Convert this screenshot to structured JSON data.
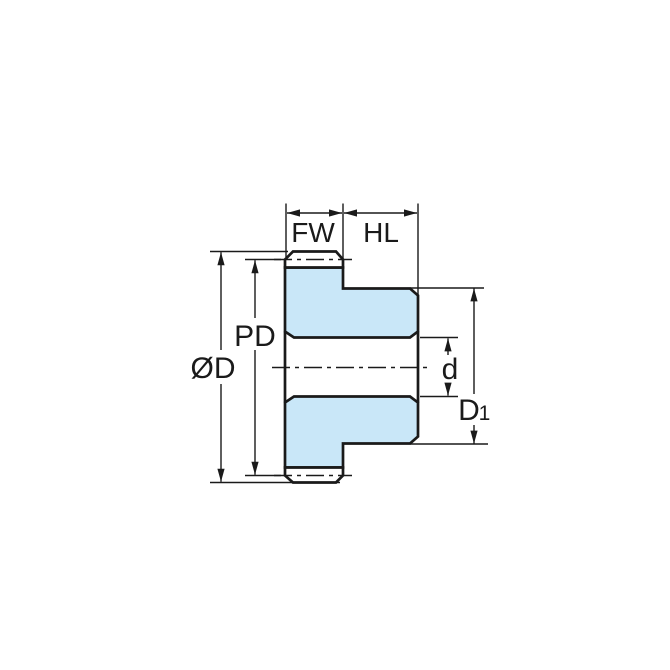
{
  "diagram": {
    "labels": {
      "face_width": "FW",
      "hub_length": "HL",
      "pitch_diameter": "PD",
      "outside_diameter": "ØD",
      "bore_diameter": "d",
      "hub_diameter_base": "D",
      "hub_diameter_sub": "1"
    },
    "colors": {
      "gear_fill": "#c9e7f8",
      "line": "#1a1a1a",
      "background": "#ffffff"
    }
  }
}
